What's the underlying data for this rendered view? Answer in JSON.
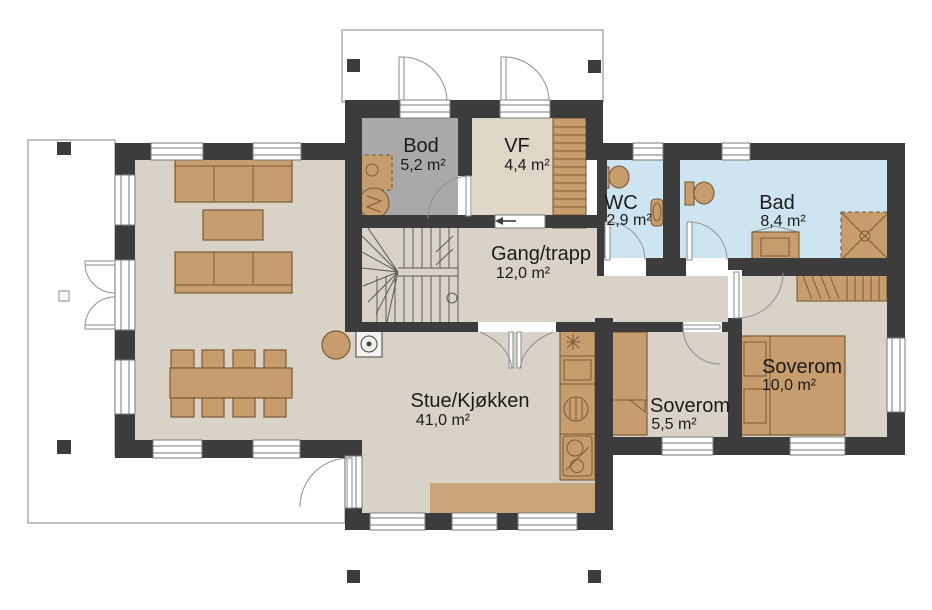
{
  "plan": {
    "rooms": [
      {
        "name": "Bod",
        "area": "5,2 m²"
      },
      {
        "name": "VF",
        "area": "4,4 m²"
      },
      {
        "name": "WC",
        "area": "2,9 m²"
      },
      {
        "name": "Bad",
        "area": "8,4 m²"
      },
      {
        "name": "Gang/trapp",
        "area": "12,0 m²"
      },
      {
        "name": "Stue/Kjøkken",
        "area": "41,0 m²"
      },
      {
        "name": "Soverom",
        "area": "5,5 m²"
      },
      {
        "name": "Soverom",
        "area": "10,0 m²"
      }
    ],
    "colors": {
      "wall": "#3c3c3c",
      "floor_main": "#d9d2c6",
      "floor_bod": "#a9a9a9",
      "floor_vf": "#ded6c6",
      "floor_wet": "#cde4f1",
      "floor_kitchen": "#c9a478",
      "furniture": "#c79d6e",
      "furniture_border": "#7d5a33",
      "outline": "#999999",
      "text": "#1b1b1b"
    }
  }
}
